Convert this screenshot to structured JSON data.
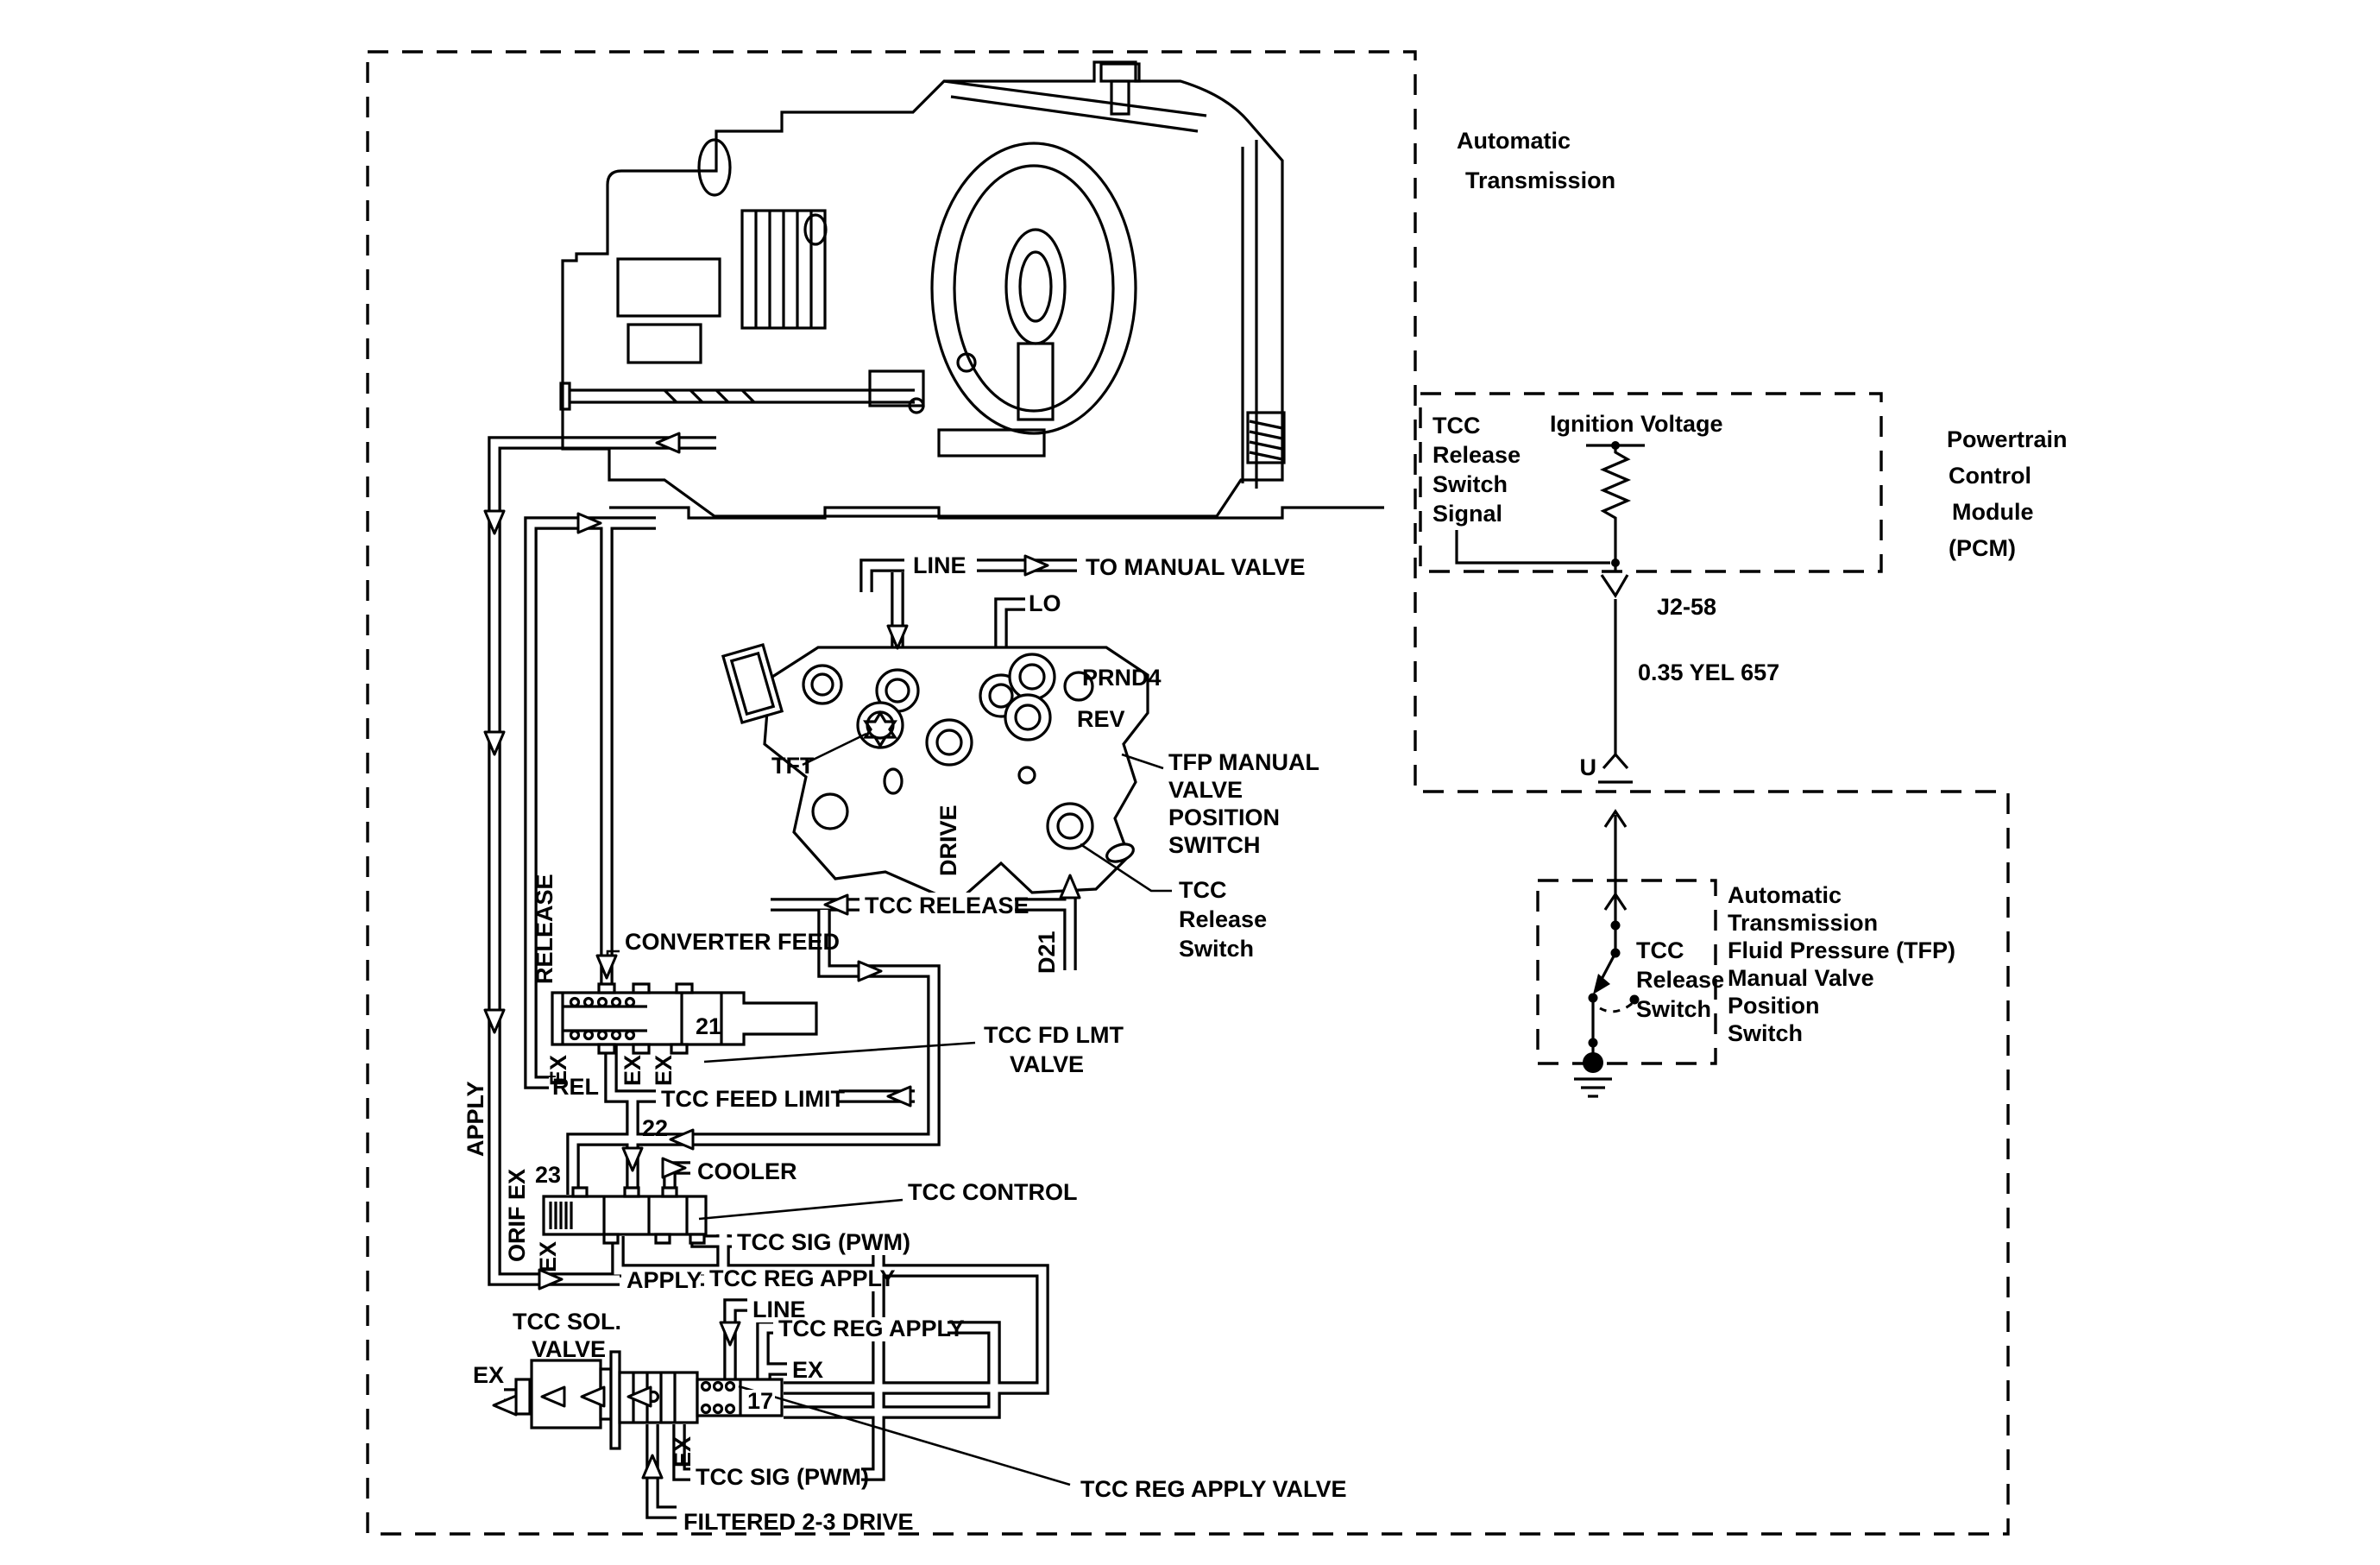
{
  "diagram": {
    "transmission_title": [
      "Automatic",
      "Transmission"
    ],
    "pcm": {
      "signal": [
        "TCC",
        "Release",
        "Switch",
        "Signal"
      ],
      "ignition": "Ignition Voltage",
      "name": [
        "Powertrain",
        "Control",
        "Module",
        "(PCM)"
      ],
      "pin": "J2-58",
      "wire": "0.35 YEL 657",
      "terminal": "U"
    },
    "tfp_box": {
      "switch": [
        "TCC",
        "Release",
        "Switch"
      ],
      "name": [
        "Automatic",
        "Transmission",
        "Fluid Pressure (TFP)",
        "Manual Valve",
        "Position",
        "Switch"
      ]
    },
    "ports": {
      "line": "LINE",
      "to_manual_valve": "TO MANUAL VALVE",
      "lo": "LO",
      "prnd4": "PRND4",
      "rev": "REV",
      "tft": "TFT",
      "drive": "DRIVE",
      "d21": "D21",
      "tcc_release": "TCC RELEASE",
      "converter_feed": "CONVERTER FEED",
      "rel": "REL",
      "tcc_feed_limit": "TCC FEED LIMIT",
      "cooler": "COOLER",
      "tcc_sig_pwm": "TCC SIG (PWM)",
      "tcc_reg_apply": "TCC REG APPLY",
      "apply": "APPLY",
      "release": "RELEASE",
      "ex": "EX",
      "orif_ex": "ORIF EX",
      "filtered_23_drive": "FILTERED 2-3 DRIVE"
    },
    "labels": {
      "tfp_manual_valve": [
        "TFP MANUAL",
        "VALVE",
        "POSITION",
        "SWITCH"
      ],
      "tcc_release_switch": [
        "TCC",
        "Release",
        "Switch"
      ],
      "tcc_fd_lmt_valve": [
        "TCC FD LMT",
        "VALVE"
      ],
      "tcc_control": "TCC CONTROL",
      "tcc_sol_valve": [
        "TCC SOL.",
        "VALVE"
      ],
      "tcc_reg_apply_valve": "TCC REG APPLY VALVE"
    },
    "valve_numbers": {
      "fd_lmt": "21",
      "feed_limit": "22",
      "control": "23",
      "reg_apply": "17"
    },
    "colors": {
      "ink": "#000000",
      "paper": "#ffffff"
    }
  }
}
